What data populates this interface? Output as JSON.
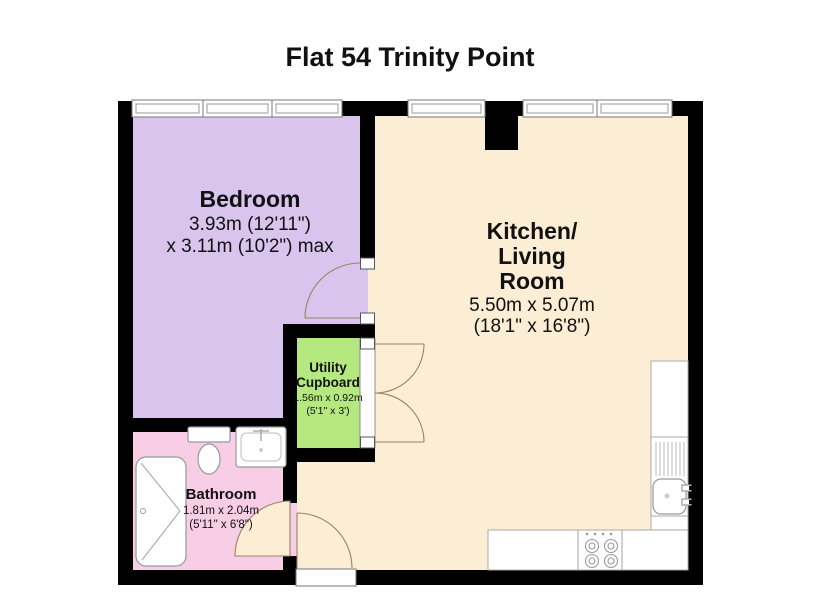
{
  "title": "Flat 54 Trinity Point",
  "colors": {
    "wall": "#000000",
    "bedroom": "#d9c4ee",
    "kitchen": "#fcedd5",
    "utility": "#b5e87e",
    "bathroom": "#f8cde6",
    "door_arc": "#9b8266"
  },
  "rooms": {
    "bedroom": {
      "name": "Bedroom",
      "dims_line1": "3.93m (12'11\")",
      "dims_line2": "x 3.11m (10'2\") max"
    },
    "kitchen_living": {
      "name_line1": "Kitchen/",
      "name_line2": "Living",
      "name_line3": "Room",
      "dims_metric": "5.50m x 5.07m",
      "dims_imperial": "(18'1\" x 16'8\")"
    },
    "utility": {
      "name_line1": "Utility",
      "name_line2": "Cupboard",
      "dims_metric": "1.56m x 0.92m",
      "dims_imperial": "(5'1\" x 3')"
    },
    "bathroom": {
      "name": "Bathroom",
      "dims_metric": "1.81m x 2.04m",
      "dims_imperial": "(5'11\" x 6'8\")"
    }
  }
}
